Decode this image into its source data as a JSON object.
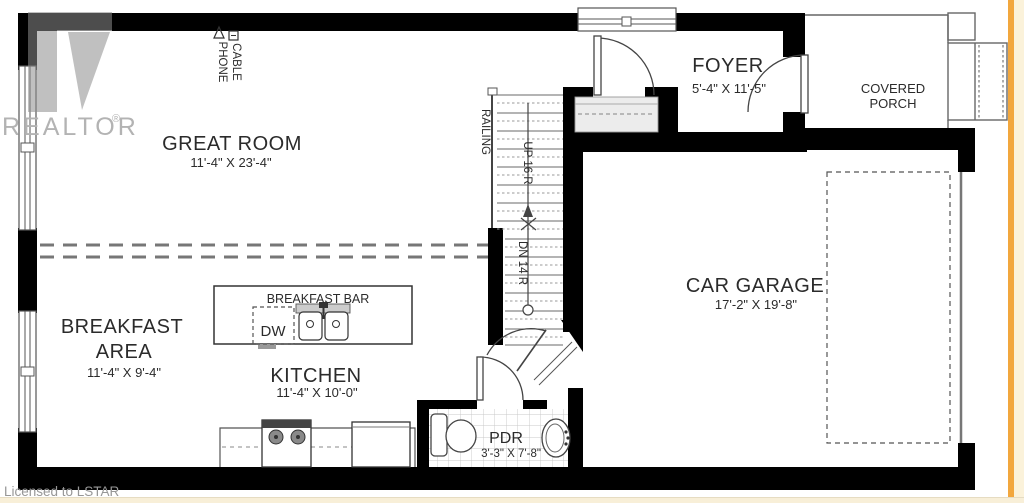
{
  "watermark": {
    "logo_letter": "R",
    "brand": "REALTOR",
    "registered": "®"
  },
  "footer": {
    "license": "Licensed to LSTAR"
  },
  "rooms": {
    "great_room": {
      "name": "GREAT ROOM",
      "dims": "11'-4\" X 23'-4\""
    },
    "foyer": {
      "name": "FOYER",
      "dims": "5'-4\" X 11'-5\""
    },
    "covered_porch": {
      "line1": "COVERED",
      "line2": "PORCH"
    },
    "car_garage": {
      "name": "CAR GARAGE",
      "dims": "17'-2\" X 19'-8\""
    },
    "breakfast_area": {
      "line1": "BREAKFAST",
      "line2": "AREA",
      "dims": "11'-4\" X 9'-4\""
    },
    "kitchen": {
      "name": "KITCHEN",
      "dims": "11'-4\" X 10'-0\""
    },
    "pdr": {
      "name": "PDR",
      "dims": "3'-3\" X 7'-8\""
    }
  },
  "fixtures": {
    "breakfast_bar": "BREAKFAST BAR",
    "dishwasher": "DW"
  },
  "stairs": {
    "railing": "RAILING",
    "up": "UP 16 R",
    "down": "DN 14 R"
  },
  "utilities": {
    "phone": "PHONE",
    "cable": "CABLE"
  },
  "colors": {
    "wall": "#000000",
    "thin_line": "#555555",
    "edge_stripe": "#f2a73e",
    "edge_cream": "#fbf2da",
    "watermark_gray": "#a8a8a8",
    "closet_fill": "#ececec",
    "tile_line": "#c8c8c8"
  }
}
